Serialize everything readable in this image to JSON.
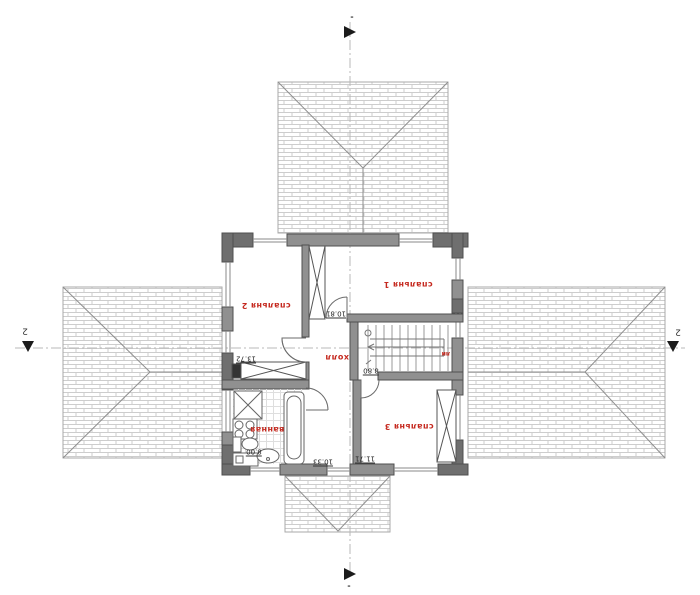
{
  "rooms": {
    "bedroom1": {
      "label": "спальня 1",
      "area": "10.81"
    },
    "bedroom2": {
      "label": "спальня 2",
      "area": "13.72"
    },
    "bedroom3": {
      "label": "спальня 3",
      "area": "11.71"
    },
    "bathroom": {
      "label": "ванная",
      "area": "8.00"
    },
    "hall": {
      "label": "холл",
      "area": "10.33"
    },
    "stairs": {
      "label": "ли",
      "area": "8.80"
    }
  },
  "section_marks": {
    "horizontal_left": "2",
    "horizontal_right": "2",
    "vertical_top": "-",
    "vertical_bottom": "-"
  },
  "colors": {
    "wall": "#909090",
    "wall_dark": "#6f6f6f",
    "accent_red": "#c5291f",
    "roof_line": "#cdcdcd",
    "axis": "#b8b8b8"
  }
}
